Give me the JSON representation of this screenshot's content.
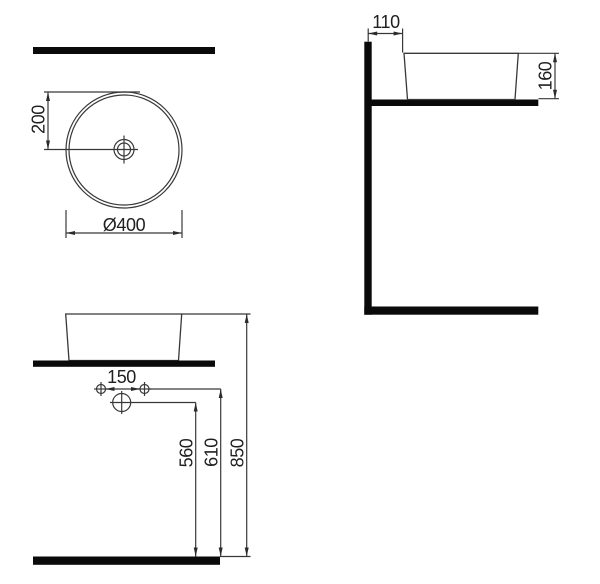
{
  "drawing": {
    "kind": "technical-dimension-drawing",
    "subject": "round-countertop-washbasin",
    "colors": {
      "background": "#ffffff",
      "thin_line": "#383838",
      "solid_bar": "#0a0a0a",
      "text": "#1f1f1f"
    },
    "views": {
      "top": {
        "label": "top-view",
        "dims": {
          "center_offset": "200",
          "diameter": "Ø400"
        }
      },
      "side": {
        "label": "side-view",
        "dims": {
          "wall_to_basin": "110",
          "basin_height": "160"
        }
      },
      "front": {
        "label": "front-view",
        "dims": {
          "tap_hole_spacing": "150",
          "drain_height": "560",
          "tap_line_height": "610",
          "rim_height": "850"
        }
      }
    }
  }
}
